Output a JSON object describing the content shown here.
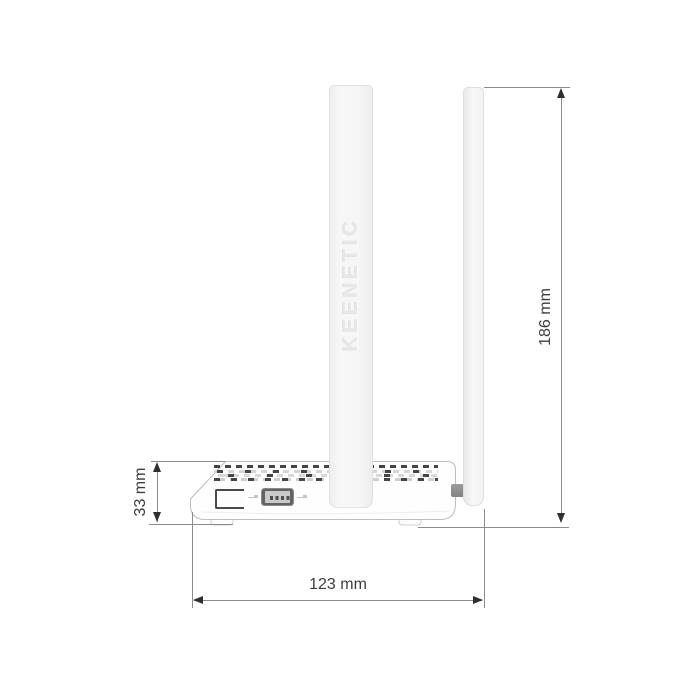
{
  "diagram": {
    "product": "KEENETIC",
    "view": "side-view-dimension-drawing",
    "dimensions": {
      "total_height": "186 mm",
      "body_height": "33 mm",
      "body_width": "123 mm"
    },
    "icons": [
      "usb-icon",
      "arrow-up-icon",
      "arrow-down-icon",
      "arrow-left-icon",
      "arrow-right-icon"
    ],
    "colors": {
      "background": "#ffffff",
      "dimension_line": "#8c8c8c",
      "dimension_arrow": "#2f2f2f",
      "dimension_text": "#3d3d3d",
      "body_outline": "#bdbdbd",
      "antenna_fill": "#f5f5f5",
      "emboss_text": "#e7e7e7",
      "vent_dark": "#454545",
      "vent_light": "#d6d6d6",
      "usb_port_dark": "#636363",
      "usb_port_inner": "#cacaca",
      "hinge_gray": "#8f8f8f"
    }
  }
}
